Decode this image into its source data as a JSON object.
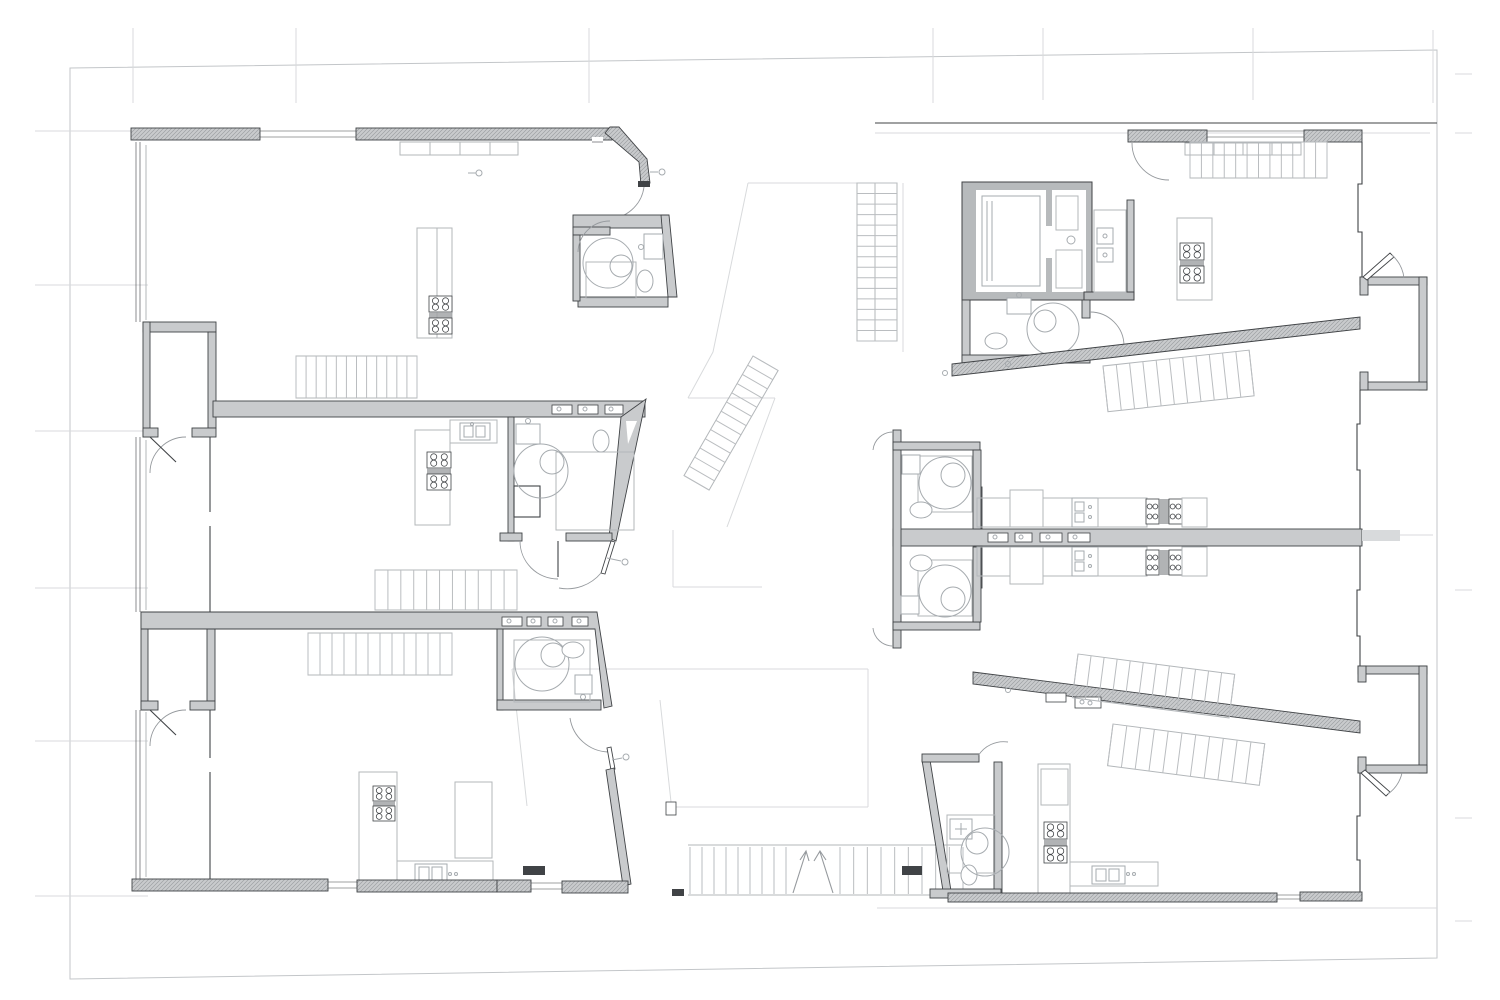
{
  "meta": {
    "title": "Apartment building floor plan — seven units around a central stair atrium",
    "drawing_type": "architectural plan, black/grey linework on white, no text labels",
    "orientation": "two wings (left and right) joined by a central courtyard with stairs and a bottom entrance stair"
  },
  "palette": {
    "background": "#ffffff",
    "wall-fill": "#c9cbcd",
    "wall-dark": "#404346",
    "core-fill": "#b7babc",
    "line-light": "#b3b7ba",
    "line-faint": "#d8dadc",
    "fixture": "#a6abaf",
    "stair": "#babdc0",
    "hatch": "#9da0a3",
    "door": "#969a9e",
    "boundary": "#c3c6c9"
  },
  "inventory": {
    "apartment_units": 7,
    "bathrooms": 8,
    "showers": 8,
    "toilets": 8,
    "kitchen_counters": 8,
    "cooktop_clusters": 14,
    "elevators": 1,
    "stair_flights": 11,
    "entry_niches": 4,
    "wall_niche_slots": 13,
    "door_swings": 14
  },
  "site": {
    "boundary_ticks_left": 6,
    "grid_ticks_top": 7,
    "boundary_ticks_right": 5
  }
}
